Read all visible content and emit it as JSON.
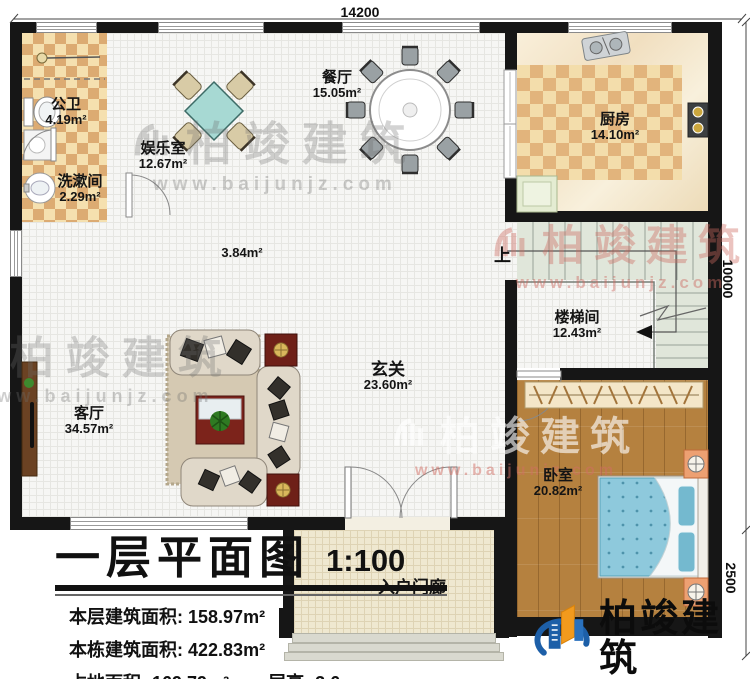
{
  "title_block": {
    "title": "一层平面图",
    "scale": "1:100",
    "stat1_label": "本层建筑面积:",
    "stat1_value": "158.97m²",
    "stat2_label": "本栋建筑面积:",
    "stat2_value": "422.83m²",
    "stat3_label": "占地面积:",
    "stat3_value": "169.79m²",
    "stat4_label": "层高:",
    "stat4_value": "3.6m"
  },
  "dimensions": {
    "top": "14200",
    "right_upper": "10000",
    "right_lower": "2500"
  },
  "rooms": [
    {
      "name": "公卫",
      "area": "4.19m²"
    },
    {
      "name": "洗漱间",
      "area": "2.29m²"
    },
    {
      "name": "娱乐室",
      "area": "12.67m²"
    },
    {
      "name": "餐厅",
      "area": "15.05m²"
    },
    {
      "name": "厨房",
      "area": "14.10m²"
    },
    {
      "name": "",
      "area": "3.84m²"
    },
    {
      "name": "楼梯间",
      "area": "12.43m²"
    },
    {
      "name": "玄关",
      "area": "23.60m²"
    },
    {
      "name": "客厅",
      "area": "34.57m²"
    },
    {
      "name": "卧室",
      "area": "20.82m²"
    },
    {
      "name": "入户门廊",
      "area": ""
    }
  ],
  "stairs_up_label": "上",
  "watermark": {
    "brand": "柏竣建筑",
    "url": "www.baijunjz.com"
  },
  "logo": {
    "brand": "柏竣建筑",
    "url": "www.baijunjz.com"
  },
  "colors": {
    "wall": "#161616",
    "wood_floor": "#b5813f",
    "tile_checker": "#dcab72",
    "bed": "#8ec9dc",
    "stairs": "#e0e6da",
    "logo_blue": "#1d5fa8",
    "logo_orange": "#f29a1d"
  }
}
